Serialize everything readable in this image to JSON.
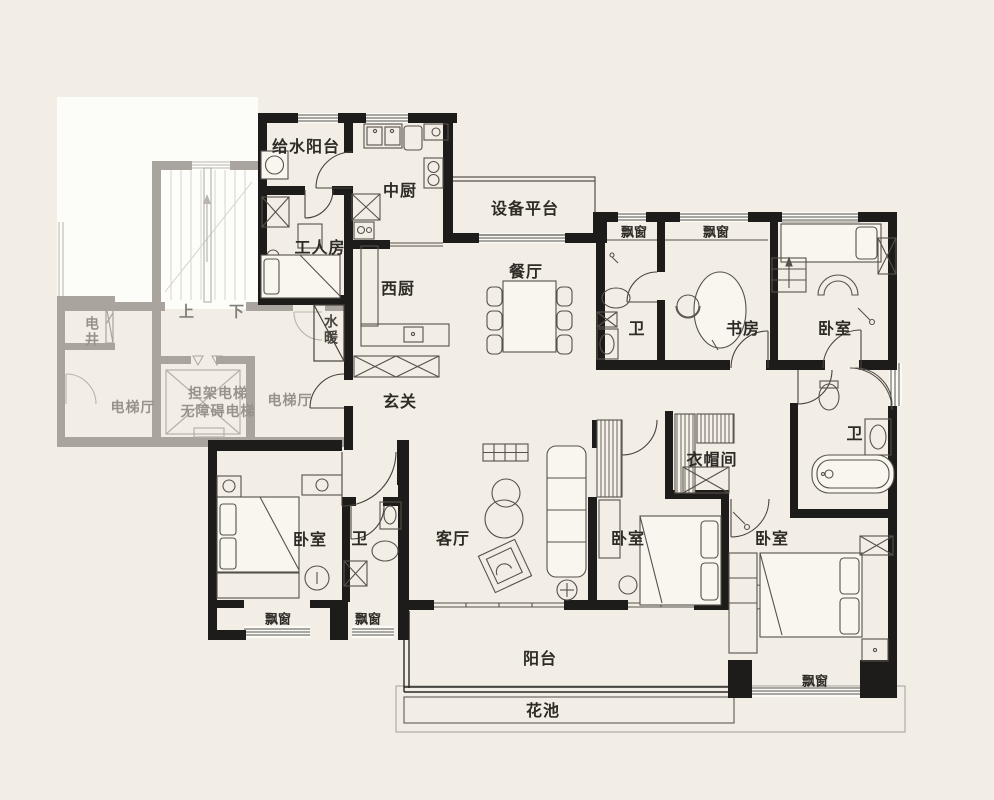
{
  "palette": {
    "background": "#f3eee5",
    "wall_black": "#1d1c1a",
    "wall_gray": "#a9a59e",
    "thin_line": "#55514b",
    "faded_line": "#cfccc5",
    "white_floor": "#fcfcf8",
    "label_dark": "#2e2b27",
    "label_gray": "#97938b"
  },
  "rooms": [
    {
      "id": "water-supply-balcony",
      "label": "给水阳台"
    },
    {
      "id": "chinese-kitchen",
      "label": "中厨"
    },
    {
      "id": "equipment-platform",
      "label": "设备平台"
    },
    {
      "id": "worker-room",
      "label": "工人房"
    },
    {
      "id": "western-kitchen",
      "label": "西厨"
    },
    {
      "id": "dining-room",
      "label": "餐厅"
    },
    {
      "id": "bay-window-top-1",
      "label": "飘窗"
    },
    {
      "id": "bay-window-top-2",
      "label": "飘窗"
    },
    {
      "id": "bath-top",
      "label": "卫"
    },
    {
      "id": "study",
      "label": "书房"
    },
    {
      "id": "bedroom-top-right",
      "label": "卧室"
    },
    {
      "id": "foyer",
      "label": "玄关"
    },
    {
      "id": "plumbing-shaft",
      "label": "水暖"
    },
    {
      "id": "walk-in-closet",
      "label": "衣帽间"
    },
    {
      "id": "bath-right",
      "label": "卫"
    },
    {
      "id": "bedroom-bottom-left",
      "label": "卧室"
    },
    {
      "id": "bath-bottom-left",
      "label": "卫"
    },
    {
      "id": "living-room",
      "label": "客厅"
    },
    {
      "id": "bedroom-bottom-middle",
      "label": "卧室"
    },
    {
      "id": "bedroom-bottom-right",
      "label": "卧室"
    },
    {
      "id": "bay-window-bottom-1",
      "label": "飘窗"
    },
    {
      "id": "bay-window-bottom-2",
      "label": "飘窗"
    },
    {
      "id": "balcony",
      "label": "阳台"
    },
    {
      "id": "flower-bed",
      "label": "花池"
    },
    {
      "id": "bay-window-bottom-right",
      "label": "飘窗"
    }
  ],
  "core": [
    {
      "id": "electrical-shaft",
      "label": "电井"
    },
    {
      "id": "stairs-up",
      "label": "上"
    },
    {
      "id": "stairs-down",
      "label": "下"
    },
    {
      "id": "stretcher-elevator",
      "label": "担架电梯"
    },
    {
      "id": "accessible-elevator",
      "label": "无障碍电梯"
    },
    {
      "id": "elevator-hall-left",
      "label": "电梯厅"
    },
    {
      "id": "elevator-hall-right",
      "label": "电梯厅"
    }
  ]
}
